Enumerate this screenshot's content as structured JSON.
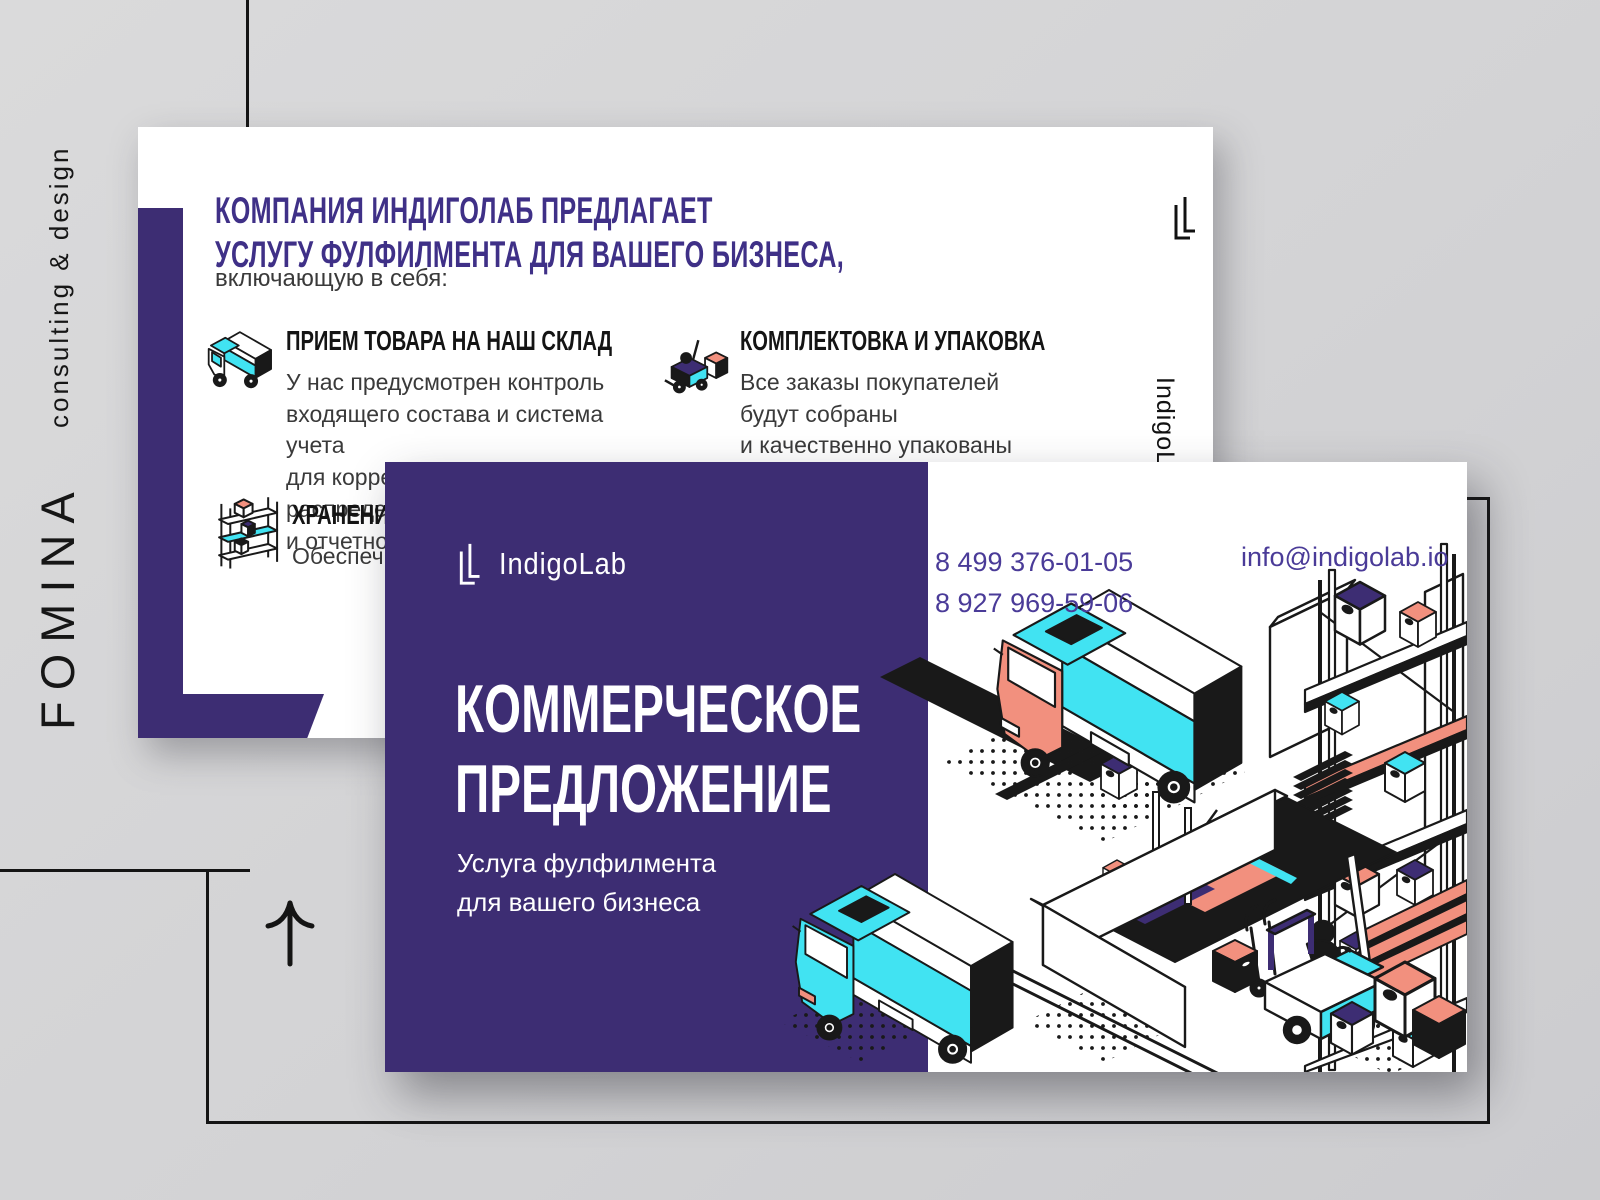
{
  "studio": {
    "name": "FOMINA",
    "tagline": "consulting & design"
  },
  "back_slide": {
    "heading": "КОМПАНИЯ ИНДИГОЛАБ ПРЕДЛАГАЕТ\nУСЛУГУ ФУЛФИЛМЕНТА ДЛЯ ВАШЕГО БИЗНЕСА,",
    "subheading": "включающую в себя:",
    "items": [
      {
        "title": "ПРИЕМ ТОВАРА НА НАШ СКЛАД",
        "body": "У нас предусмотрен контроль\nвходящего состава и система учета\nдля корректного распределения\nи отчетности",
        "icon": "delivery-truck-icon"
      },
      {
        "title": "КОМПЛЕКТОВКА И УПАКОВКА",
        "body": "Все заказы покупателей\nбудут собраны\nи качественно упакованы",
        "icon": "forklift-icon"
      },
      {
        "title": "ХРАНЕНИЕ",
        "body": "Обеспечи",
        "icon": "shelf-rack-icon"
      }
    ],
    "vertical_brand": "IndigoLab"
  },
  "front_slide": {
    "logo_text": "IndigoLab",
    "title": "КОММЕРЧЕСКОЕ\nПРЕДЛОЖЕНИЕ",
    "subtitle": "Услуга фулфилмента\nдля вашего бизнеса",
    "phone1": "8 499 376-01-05",
    "phone2": "8 927 969-59-06",
    "email": "info@indigolab.io"
  },
  "colors": {
    "purple": "#3d2d73",
    "heading_purple": "#3f3087",
    "contact_purple": "#4a3b98",
    "cyan": "#41e3f2",
    "coral": "#f2907e",
    "ink": "#191919",
    "background": "#d4d4d6"
  }
}
